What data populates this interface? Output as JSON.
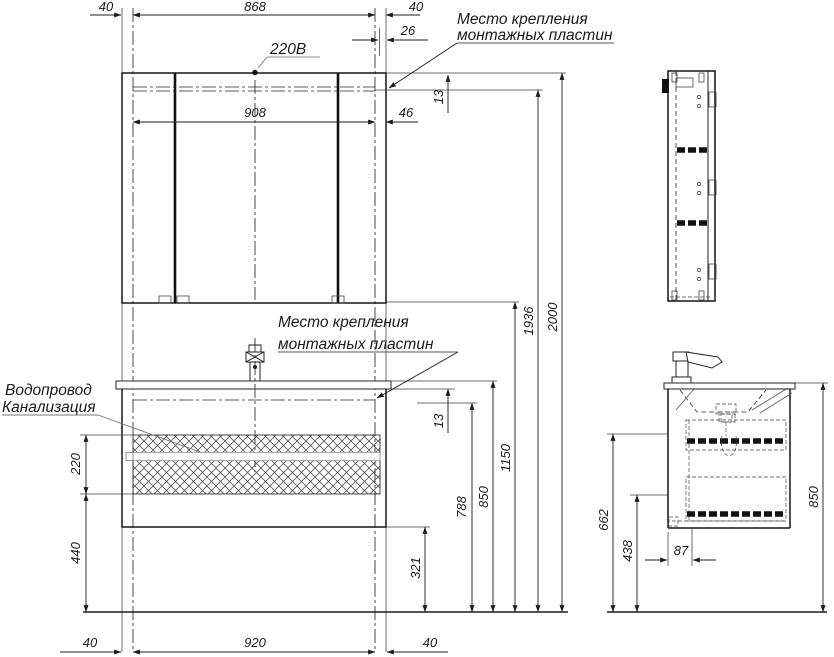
{
  "annotations": {
    "power": "220В",
    "mount_plate_line1": "Место крепления",
    "mount_plate_line2": "монтажных пластин",
    "water_supply": "Водопровод",
    "sewerage": "Канализация"
  },
  "front_dims": {
    "top_offset_left": "40",
    "top_span": "868",
    "top_offset_right": "40",
    "plate_inset": "26",
    "plate_top_gap": "13",
    "inner_span": "908",
    "inner_edge": "46",
    "under_top_gap": "13",
    "h_plate_bottom": "788",
    "h_worktop": "850",
    "h_mirror_bottom": "1150",
    "h_plate_top": "1936",
    "h_total": "2000",
    "h_cabinet_bottom": "321",
    "service_zone": "220",
    "h_service_bottom": "440",
    "bottom_offset_left": "40",
    "bottom_span": "920",
    "bottom_offset_right": "40"
  },
  "side_dims": {
    "height": "850",
    "h_drawer_divider": "662",
    "h_cabinet_bottom": "438",
    "back_offset": "87"
  },
  "colors": {
    "ink": "#1c1c1c",
    "gray": "#8d8d8d",
    "background": "#ffffff"
  }
}
